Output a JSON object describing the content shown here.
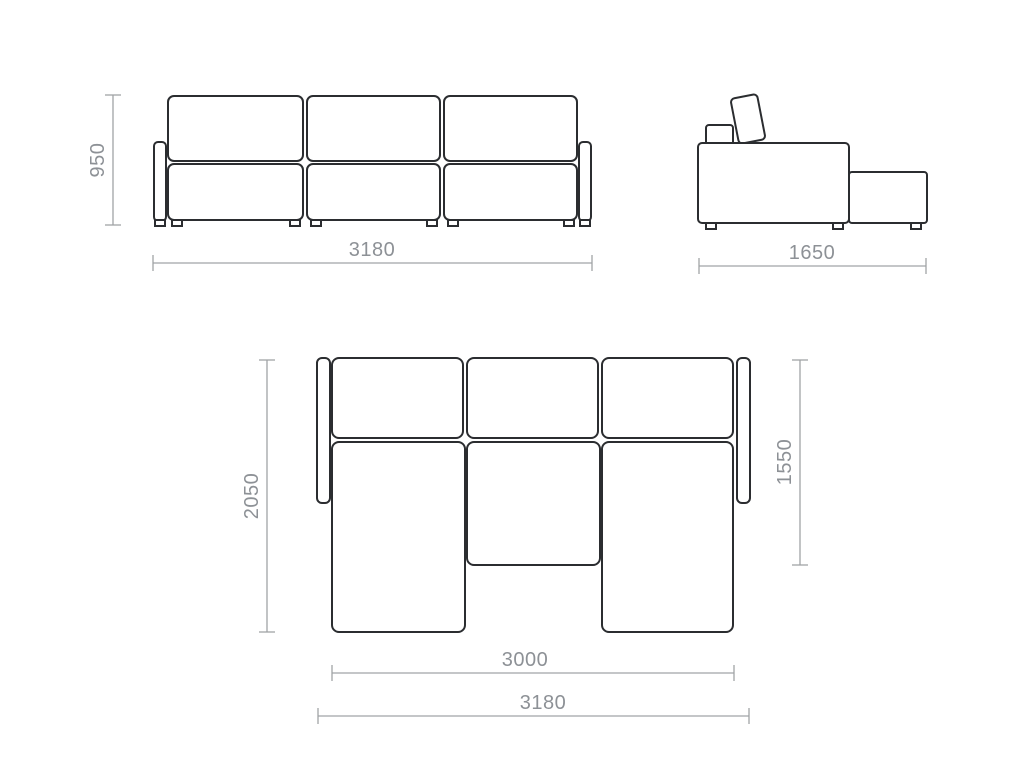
{
  "drawing": {
    "title": "modular-sofa-technical-drawing",
    "colors": {
      "background": "#ffffff",
      "outline": "#2b2d30",
      "dimension_line": "#a0a3a6",
      "dimension_text": "#8d9196"
    },
    "views": {
      "front": {
        "name": "front view",
        "modules": 3,
        "dimensions": {
          "height": "950",
          "width": "3180"
        }
      },
      "side": {
        "name": "side view",
        "dimensions": {
          "depth": "1650"
        }
      },
      "plan": {
        "name": "plan view (unfolded)",
        "modules": 3,
        "dimensions": {
          "depth_total": "2050",
          "depth_chaise": "1550",
          "width_inner": "3000",
          "width_total": "3180"
        }
      }
    }
  }
}
